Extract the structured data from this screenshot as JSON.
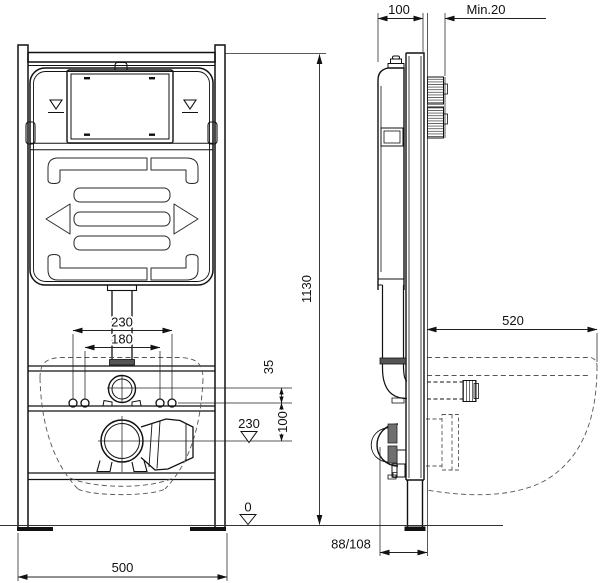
{
  "colors": {
    "ink": "#111111",
    "dimension_line": "#222222",
    "dashed_outline": "#555555",
    "socket_fill": "#6f6f6f",
    "background": "#ffffff"
  },
  "front_view": {
    "overall_width": "500",
    "overall_height": "1130",
    "bolt_spacing_outer": "230",
    "bolt_spacing_inner": "180",
    "supply_above_bolts": "35",
    "bolts_above_drain": "100",
    "drain_height_datum": "230",
    "floor_datum": "0"
  },
  "side_view": {
    "frame_depth": "100",
    "min_front_clearance": "Min.20",
    "bowl_projection": "520",
    "outlet_wall_distance": "88/108"
  }
}
